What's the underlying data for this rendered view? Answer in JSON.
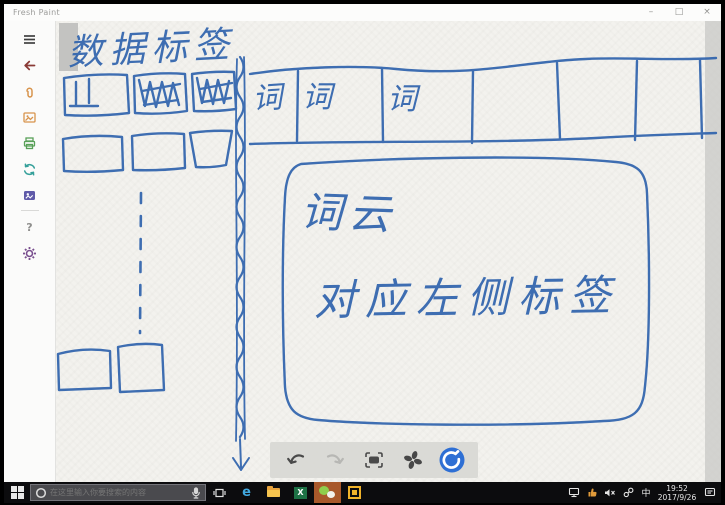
{
  "colors": {
    "ink": "#2f63ad",
    "paper": "#f3f2ee",
    "taskbar": "#0c0c0e",
    "wechat_tile_highlight": "#a8582a",
    "blue_tool_button": "#2e6fd4"
  },
  "window": {
    "title": "Fresh Paint",
    "controls": {
      "minimize": "–",
      "restore": "□",
      "close": "×"
    }
  },
  "sidebar": {
    "icons": [
      "menu",
      "back",
      "paperclip",
      "photo",
      "printer",
      "refresh",
      "gallery",
      "help",
      "settings"
    ],
    "help_glyph": "?"
  },
  "canvas": {
    "sketch": {
      "title": "数据标签",
      "header_cells": [
        "词",
        "词",
        "词",
        "",
        "",
        "",
        ""
      ],
      "cloud_title": "词云",
      "cloud_note": "对应左侧标签"
    }
  },
  "float_toolbar": {
    "icons": [
      "undo",
      "redo",
      "fit-screen",
      "fan-brush",
      "clean-brush"
    ]
  },
  "taskbar": {
    "search": {
      "placeholder": "在这里输入你要搜索的内容"
    },
    "apps": [
      {
        "name": "task-view"
      },
      {
        "name": "edge",
        "glyph": "e"
      },
      {
        "name": "file-explorer"
      },
      {
        "name": "excel",
        "glyph": "X"
      },
      {
        "name": "wechat"
      },
      {
        "name": "dingtalk"
      }
    ],
    "tray": {
      "ime": "中",
      "time": "19:52",
      "date": "2017/9/26"
    }
  }
}
